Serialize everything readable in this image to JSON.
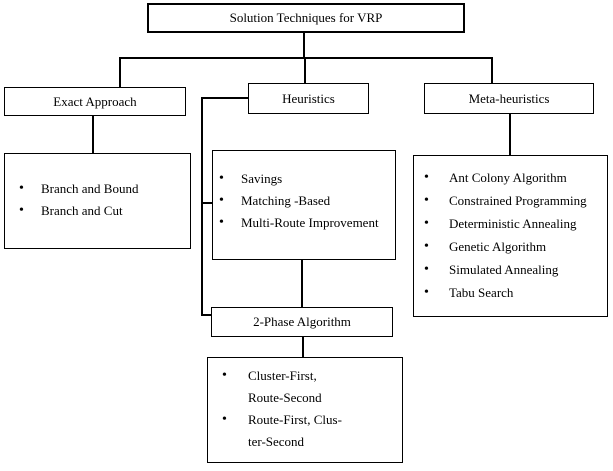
{
  "diagram": {
    "bullet": "•",
    "colors": {
      "background": "#ffffff",
      "line": "#000000",
      "text": "#000000"
    },
    "root": {
      "label": "Solution Techniques for VRP"
    },
    "exact": {
      "label": "Exact Approach",
      "items": [
        "Branch and Bound",
        "Branch and Cut"
      ]
    },
    "heuristics": {
      "label": "Heuristics",
      "items": [
        "Savings",
        "Matching -Based",
        "Multi-Route Improvement"
      ]
    },
    "two_phase": {
      "label": "2-Phase Algorithm",
      "items": [
        [
          "Cluster-First,",
          "Route-Second"
        ],
        [
          "Route-First, Clus-",
          "ter-Second"
        ]
      ]
    },
    "meta": {
      "label": "Meta-heuristics",
      "items": [
        "Ant Colony Algorithm",
        "Constrained Programming",
        "Deterministic Annealing",
        "Genetic Algorithm",
        "Simulated Annealing",
        "Tabu Search"
      ]
    }
  }
}
